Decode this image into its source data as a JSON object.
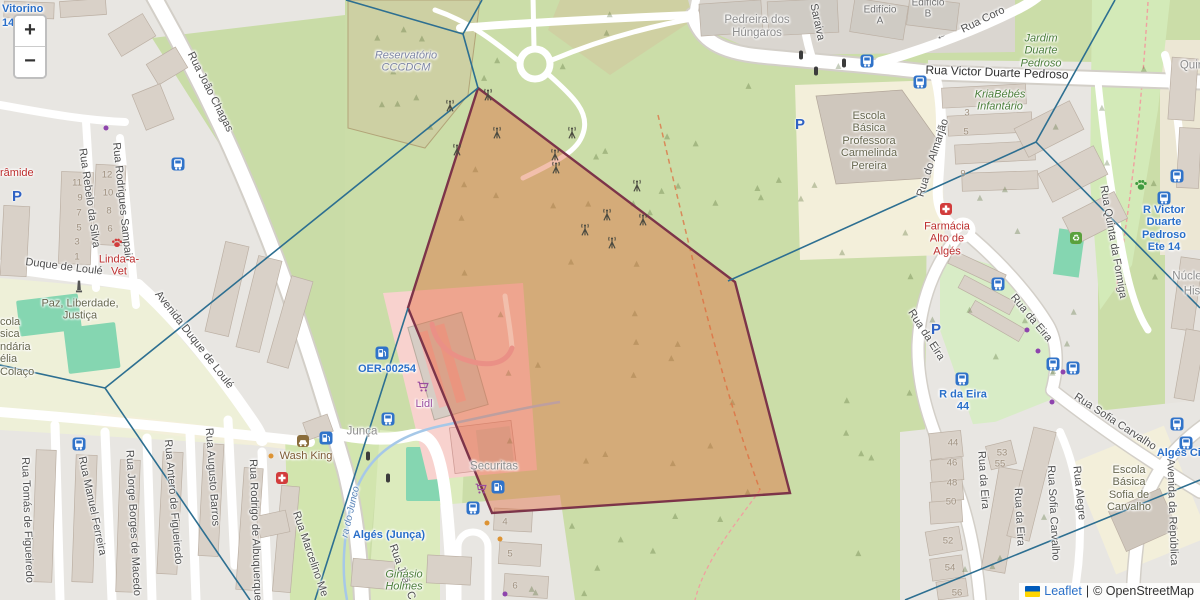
{
  "controls": {
    "zoom_in": "+",
    "zoom_out": "−"
  },
  "attribution": {
    "leaflet_link": "Leaflet",
    "separator": "|",
    "copyright": "© OpenStreetMap"
  },
  "colors": {
    "overlay_fill": "#e0663a",
    "overlay_stroke": "#7c3449",
    "overlay_opacity": 0.42,
    "voronoi_line": "#2d6f91",
    "transit_blue": "#2a6fc9",
    "icon_blue": "#3073c9",
    "purple": "#9a4d9e",
    "red": "#d23c3c",
    "green_icon": "#3f9b3f",
    "brown": "#8a6d3b"
  },
  "overlay": {
    "polygon": [
      [
        478,
        88
      ],
      [
        735,
        282
      ],
      [
        790,
        493
      ],
      [
        492,
        513
      ],
      [
        408,
        308
      ]
    ],
    "voronoi_lines": [
      [
        346,
        0,
        463,
        34
      ],
      [
        482,
        0,
        463,
        34
      ],
      [
        463,
        34,
        478,
        88
      ],
      [
        478,
        88,
        105,
        388
      ],
      [
        105,
        388,
        0,
        365
      ],
      [
        105,
        388,
        250,
        600
      ],
      [
        408,
        308,
        315,
        600
      ],
      [
        728,
        281,
        1036,
        142
      ],
      [
        1036,
        142,
        1115,
        0
      ],
      [
        1036,
        142,
        1200,
        308
      ],
      [
        905,
        600,
        1200,
        480
      ]
    ]
  },
  "labels": [
    {
      "n": "street-rua-joao-chagas",
      "t": "Rua João Chagas",
      "x": 210,
      "y": 92,
      "r": 63,
      "k": "st"
    },
    {
      "n": "street-duque-de-loule",
      "t": "Duque de Loulé",
      "x": 64,
      "y": 267,
      "r": 7,
      "k": "st"
    },
    {
      "n": "street-avenida-duque-de-loule",
      "t": "Avenida Duque de Loulé",
      "x": 194,
      "y": 340,
      "r": 52,
      "k": "st"
    },
    {
      "n": "street-rua-rebelo-da-silva",
      "t": "Rua Rebelo da Silva",
      "x": 89,
      "y": 198,
      "r": 82,
      "k": "st"
    },
    {
      "n": "street-rua-rodrigues-sampaio",
      "t": "Rua Rodrigues Sampaio",
      "x": 122,
      "y": 202,
      "r": 84,
      "k": "st"
    },
    {
      "n": "street-rua-tomas-de-figueiredo",
      "t": "Rua Tomás de Figueiredo",
      "x": 27,
      "y": 520,
      "r": 88,
      "k": "st"
    },
    {
      "n": "street-rua-manuel-ferreira",
      "t": "Rua Manuel Ferreira",
      "x": 92,
      "y": 506,
      "r": 78,
      "k": "st"
    },
    {
      "n": "street-rua-jorge-borges-de-macedo",
      "t": "Rua Jorge Borges de Macedo",
      "x": 133,
      "y": 523,
      "r": 87,
      "k": "st"
    },
    {
      "n": "street-rua-antero-de-figueiredo",
      "t": "Rua Antero de Figueiredo",
      "x": 173,
      "y": 502,
      "r": 85,
      "k": "st"
    },
    {
      "n": "street-rua-augusto-barros",
      "t": "Rua Augusto Barros",
      "x": 212,
      "y": 477,
      "r": 86,
      "k": "st"
    },
    {
      "n": "street-rua-rodrigo-de-albuquerque",
      "t": "Rua Rodrigo de Albuquerque",
      "x": 255,
      "y": 530,
      "r": 88,
      "k": "st"
    },
    {
      "n": "street-rua-marcelino",
      "t": "Rua Marcelino Me",
      "x": 310,
      "y": 554,
      "r": 71,
      "k": "st"
    },
    {
      "n": "street-rua-joao-c",
      "t": "Rua João C",
      "x": 402,
      "y": 572,
      "r": 70,
      "k": "st"
    },
    {
      "n": "street-saraiva",
      "t": "Saraiva",
      "x": 817,
      "y": 22,
      "r": 78,
      "k": "st"
    },
    {
      "n": "street-rua-coro",
      "t": "Rua Coro",
      "x": 983,
      "y": 20,
      "r": -26,
      "k": "st"
    },
    {
      "n": "oneway-arrow",
      "t": "←",
      "x": 941,
      "y": 36,
      "r": -22,
      "k": "st"
    },
    {
      "n": "street-rua-victor-duarte-pedroso",
      "t": "Rua Victor Duarte Pedroso",
      "x": 997,
      "y": 73,
      "r": 2,
      "k": "stM"
    },
    {
      "n": "street-rua-do-almarjao",
      "t": "Rua do Almarjão",
      "x": 933,
      "y": 158,
      "r": -72,
      "k": "st"
    },
    {
      "n": "street-rua-da-eira-1",
      "t": "Rua da Eira",
      "x": 926,
      "y": 335,
      "r": 57,
      "k": "st"
    },
    {
      "n": "street-rua-da-eira-2",
      "t": "Rua da Eira",
      "x": 1031,
      "y": 318,
      "r": 50,
      "k": "st"
    },
    {
      "n": "street-rua-da-eira-3",
      "t": "Rua da Eira",
      "x": 983,
      "y": 480,
      "r": 86,
      "k": "st"
    },
    {
      "n": "street-rua-da-eira-4",
      "t": "Rua da Eira",
      "x": 1019,
      "y": 517,
      "r": 87,
      "k": "st"
    },
    {
      "n": "street-rua-quinta-da-formiga",
      "t": "Rua Quinta da Formiga",
      "x": 1113,
      "y": 242,
      "r": 80,
      "k": "st"
    },
    {
      "n": "street-rua-sofia-carvalho-1",
      "t": "Rua Sofia Carvalho",
      "x": 1115,
      "y": 422,
      "r": 33,
      "k": "st"
    },
    {
      "n": "street-rua-sofia-carvalho-2",
      "t": "Rua Sofia Carvalho",
      "x": 1053,
      "y": 513,
      "r": 87,
      "k": "st"
    },
    {
      "n": "street-rua-alegre",
      "t": "Rua Alegre",
      "x": 1079,
      "y": 493,
      "r": 84,
      "k": "st"
    },
    {
      "n": "street-avenida-da-republica",
      "t": "Avenida da República",
      "x": 1172,
      "y": 512,
      "r": 88,
      "k": "st"
    },
    {
      "n": "place-reservatorio",
      "lines": [
        "Reservatório",
        "CCCDCM"
      ],
      "x": 406,
      "y": 62,
      "k": "wat"
    },
    {
      "n": "place-pedreira-dos-hungaros",
      "lines": [
        "Pedreira dos",
        "Húngaros"
      ],
      "x": 757,
      "y": 27,
      "k": "pl"
    },
    {
      "n": "place-edificio-a",
      "lines": [
        "Edifício",
        "A"
      ],
      "x": 880,
      "y": 16,
      "k": "pls"
    },
    {
      "n": "place-edificio-b",
      "lines": [
        "Edifício",
        "B"
      ],
      "x": 928,
      "y": 9,
      "k": "pls"
    },
    {
      "n": "place-junca",
      "t": "Junça",
      "x": 362,
      "y": 432,
      "k": "pl"
    },
    {
      "n": "place-quin",
      "t": "Quin",
      "x": 1192,
      "y": 66,
      "k": "pl"
    },
    {
      "n": "place-nucle",
      "t": "Núcle",
      "x": 1187,
      "y": 277,
      "k": "pl"
    },
    {
      "n": "place-his",
      "t": "His",
      "x": 1192,
      "y": 292,
      "k": "pl"
    },
    {
      "n": "place-securitas",
      "t": "Securitas",
      "x": 494,
      "y": 467,
      "k": "pl"
    },
    {
      "n": "poi-lidl",
      "t": "Lidl",
      "x": 424,
      "y": 404,
      "k": "pur"
    },
    {
      "n": "poi-wash-king",
      "t": "Wash King",
      "x": 306,
      "y": 456,
      "k": "brn"
    },
    {
      "n": "poi-linda-a-vet",
      "lines": [
        "Linda-a-",
        "Vet"
      ],
      "x": 119,
      "y": 266,
      "k": "red"
    },
    {
      "n": "poi-piramide",
      "t": "râmide",
      "x": 0,
      "y": 167,
      "a": "lt",
      "k": "red"
    },
    {
      "n": "poi-farmacia-alto-de-alges",
      "lines": [
        "Farmácia",
        "Alto de",
        "Algés"
      ],
      "x": 947,
      "y": 239,
      "k": "red"
    },
    {
      "n": "school-carmelinda-pereira",
      "lines": [
        "Escola",
        "Básica",
        "Professora",
        "Carmelinda",
        "Pereira"
      ],
      "x": 869,
      "y": 141,
      "k": "sch"
    },
    {
      "n": "school-left-fragment",
      "lines": [
        "cola",
        "sica",
        "ndária",
        "élia",
        "Colaço"
      ],
      "x": 0,
      "y": 316,
      "a": "lt",
      "k": "sch"
    },
    {
      "n": "school-sofia-de-carvalho",
      "lines": [
        "Escola",
        "Básica",
        "Sofia de",
        "Carvalho"
      ],
      "x": 1129,
      "y": 489,
      "k": "sch"
    },
    {
      "n": "place-paz-liberdade-justica",
      "lines": [
        "Paz, Liberdade,",
        "Justiça"
      ],
      "x": 80,
      "y": 310,
      "k": "sch"
    },
    {
      "n": "park-jardim-duarte-pedroso",
      "lines": [
        "Jardim",
        "Duarte",
        "Pedroso"
      ],
      "x": 1041,
      "y": 51,
      "k": "nat"
    },
    {
      "n": "poi-kriabebes-infantario",
      "lines": [
        "KriaBébés",
        "Infantário"
      ],
      "x": 1000,
      "y": 101,
      "k": "nat"
    },
    {
      "n": "poi-ginasio-holmes",
      "lines": [
        "Ginásio",
        "Holmes"
      ],
      "x": 404,
      "y": 581,
      "k": "nat"
    },
    {
      "n": "stream-do-junco",
      "t": "ra do Junco",
      "x": 351,
      "y": 512,
      "r": -77,
      "k": "wtr"
    },
    {
      "n": "transit-vitorino",
      "t": "Vitorino",
      "x": 2,
      "y": 3,
      "a": "lt",
      "k": "tr"
    },
    {
      "n": "transit-14",
      "t": "14",
      "x": 2,
      "y": 17,
      "a": "lt",
      "k": "tr"
    },
    {
      "n": "transit-oer-00254",
      "t": "OER-00254",
      "x": 387,
      "y": 369,
      "k": "tr"
    },
    {
      "n": "transit-alges-junca",
      "t": "Algés (Junça)",
      "x": 389,
      "y": 535,
      "k": "tr"
    },
    {
      "n": "transit-r-da-eira-44",
      "lines": [
        "R da Eira",
        "44"
      ],
      "x": 963,
      "y": 401,
      "k": "tr"
    },
    {
      "n": "transit-r-victor-duarte-pedroso-ete-14",
      "lines": [
        "R Victor",
        "Duarte",
        "Pedroso",
        "Ete 14"
      ],
      "x": 1164,
      "y": 229,
      "k": "tr"
    },
    {
      "n": "transit-alges-cir",
      "t": "Algés Cir",
      "x": 1181,
      "y": 453,
      "k": "tr"
    }
  ],
  "house_numbers": [
    [
      77,
      183,
      "11"
    ],
    [
      80,
      198,
      "9"
    ],
    [
      79,
      213,
      "7"
    ],
    [
      79,
      228,
      "5"
    ],
    [
      77,
      242,
      "3"
    ],
    [
      77,
      257,
      "1"
    ],
    [
      107,
      175,
      "12"
    ],
    [
      108,
      193,
      "10"
    ],
    [
      109,
      211,
      "8"
    ],
    [
      110,
      229,
      "6"
    ],
    [
      967,
      113,
      "3"
    ],
    [
      966,
      132,
      "5"
    ],
    [
      963,
      174,
      "9"
    ],
    [
      953,
      443,
      "44"
    ],
    [
      952,
      463,
      "46"
    ],
    [
      952,
      483,
      "48"
    ],
    [
      951,
      502,
      "50"
    ],
    [
      948,
      541,
      "52"
    ],
    [
      950,
      568,
      "54"
    ],
    [
      957,
      593,
      "56"
    ],
    [
      1002,
      453,
      "53"
    ],
    [
      1000,
      464,
      "55"
    ],
    [
      505,
      522,
      "4"
    ],
    [
      510,
      554,
      "5"
    ],
    [
      515,
      586,
      "6"
    ]
  ],
  "icons": [
    [
      "bus",
      178,
      164
    ],
    [
      "bus",
      79,
      444
    ],
    [
      "bus",
      867,
      61
    ],
    [
      "bus",
      920,
      82
    ],
    [
      "bus",
      388,
      419
    ],
    [
      "bus",
      473,
      508
    ],
    [
      "bus",
      998,
      284
    ],
    [
      "bus",
      962,
      379
    ],
    [
      "bus",
      1053,
      364
    ],
    [
      "bus",
      1073,
      368
    ],
    [
      "bus",
      1177,
      176
    ],
    [
      "bus",
      1164,
      198
    ],
    [
      "bus",
      1177,
      424
    ],
    [
      "bus",
      1186,
      443
    ],
    [
      "parking",
      17,
      197
    ],
    [
      "parking",
      800,
      125
    ],
    [
      "parking",
      936,
      330
    ],
    [
      "fuel",
      382,
      353
    ],
    [
      "fuel",
      326,
      438
    ],
    [
      "fuel",
      498,
      487
    ],
    [
      "cart",
      423,
      389
    ],
    [
      "cart",
      481,
      491
    ],
    [
      "first-aid",
      282,
      478
    ],
    [
      "pharmacy-cross",
      946,
      209
    ],
    [
      "paw-red",
      117,
      245
    ],
    [
      "paw-green",
      1141,
      187
    ],
    [
      "recycling",
      1076,
      238
    ],
    [
      "car-wash",
      303,
      441
    ],
    [
      "monument",
      79,
      289
    ],
    [
      "traffic-light",
      801,
      55
    ],
    [
      "traffic-light",
      816,
      71
    ],
    [
      "traffic-light",
      844,
      63
    ],
    [
      "traffic-light",
      368,
      456
    ],
    [
      "traffic-light",
      388,
      478
    ],
    [
      "antenna",
      450,
      108
    ],
    [
      "antenna",
      488,
      97
    ],
    [
      "antenna",
      457,
      152
    ],
    [
      "antenna",
      497,
      135
    ],
    [
      "antenna",
      572,
      135
    ],
    [
      "antenna",
      555,
      157
    ],
    [
      "antenna",
      556,
      170
    ],
    [
      "antenna",
      637,
      188
    ],
    [
      "antenna",
      643,
      222
    ],
    [
      "antenna",
      607,
      217
    ],
    [
      "antenna",
      585,
      232
    ],
    [
      "antenna",
      612,
      245
    ],
    [
      "dot-orange",
      271,
      456
    ],
    [
      "dot-orange",
      487,
      523
    ],
    [
      "dot-orange",
      500,
      539
    ],
    [
      "dot-purple",
      505,
      594
    ],
    [
      "dot-purple",
      1052,
      402
    ],
    [
      "dot-purple",
      1063,
      372
    ],
    [
      "dot-purple",
      1027,
      330
    ],
    [
      "dot-purple",
      1038,
      351
    ],
    [
      "dot-purple",
      106,
      128
    ]
  ]
}
